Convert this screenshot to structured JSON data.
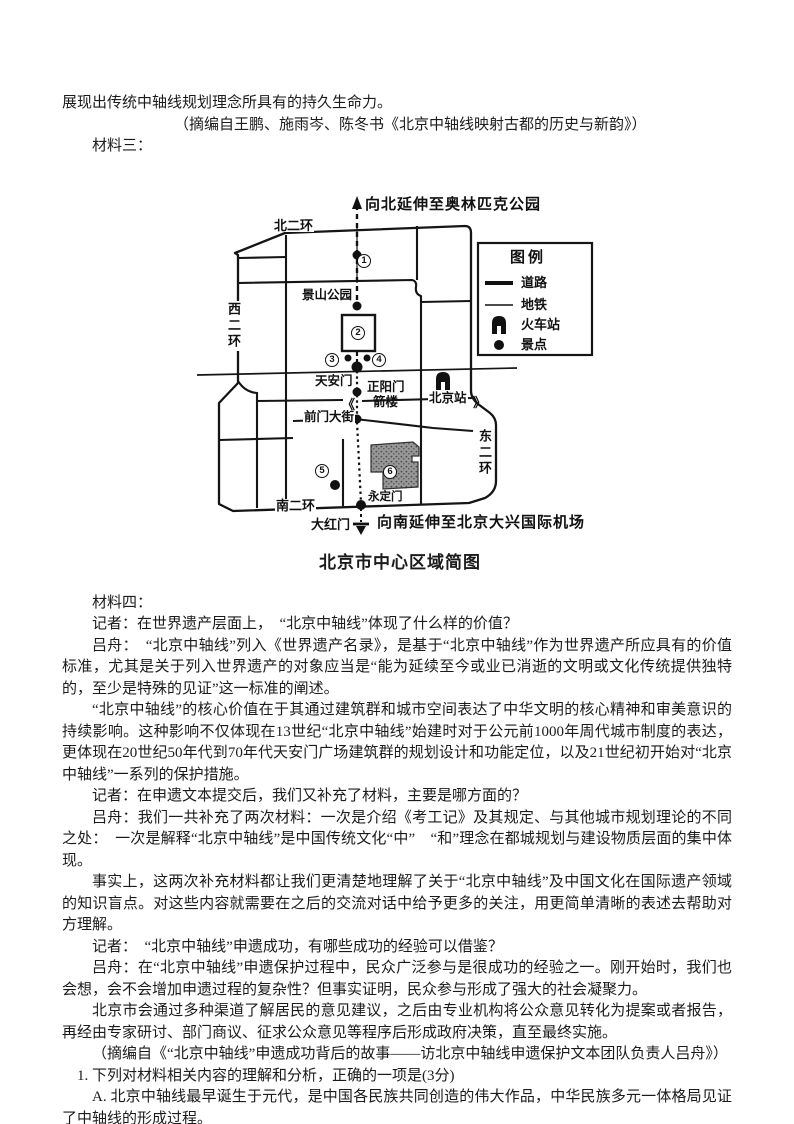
{
  "colors": {
    "ink": "#1b1b1b",
    "tiantan_gray": "#8f8f8f",
    "paper": "#ffffff"
  },
  "header": {
    "intro_line": "展现出传统中轴线规划理念所具有的持久生命力。",
    "source3": "（摘编自王鹏、施雨岑、陈冬书《北京中轴线映射古都的历史与新韵》）",
    "material3_label": "材料三："
  },
  "map": {
    "title": "北京市中心区域简图",
    "north_extension": "向北延伸至奥林匹克公园",
    "south_extension": "向南延伸至北京大兴国际机场",
    "ring_north": "北二环",
    "ring_west": "西二环",
    "ring_east": "东二环",
    "ring_south": "南二环",
    "jingshan": "景山公园",
    "tiananmen": "天安门",
    "zhengyangmen": "正阳门",
    "jianlou": "箭楼",
    "beijing_station": "北京站",
    "qianmen_street": "前门大街",
    "yongdingmen": "永定门",
    "dahongmen": "大红门",
    "break_left": "《",
    "break_right": "》",
    "spots": [
      "1",
      "2",
      "3",
      "4",
      "5",
      "6"
    ],
    "legend": {
      "title": "图例",
      "road": "道路",
      "subway": "地铁",
      "train_station": "火车站",
      "scenic_spot": "景点"
    }
  },
  "interview": {
    "material4_label": "材料四：",
    "paragraphs": [
      "记者：在世界遗产层面上，　“北京中轴线”体现了什么样的价值？",
      "吕舟：　“北京中轴线”列入《世界遗产名录》，是基于“北京中轴线”作为世界遗产所应具有的价值标准，尤其是关于列入世界遗产的对象应当是“能为延续至今或业已消逝的文明或文化传统提供独特的，至少是特殊的见证”这一标准的阐述。",
      "“北京中轴线”的核心价值在于其通过建筑群和城市空间表达了中华文明的核心精神和审美意识的持续影响。这种影响不仅体现在13世纪“北京中轴线”始建时对于公元前1000年周代城市制度的表达，更体现在20世纪50年代到70年代天安门广场建筑群的规划设计和功能定位，以及21世纪初开始对“北京中轴线”一系列的保护措施。",
      "记者：在申遗文本提交后，我们又补充了材料，主要是哪方面的？",
      "吕舟：我们一共补充了两次材料：一次是介绍《考工记》及其规定、与其他城市规划理论的不同之处：　一次是解释“北京中轴线”是中国传统文化“中”　“和”理念在都城规划与建设物质层面的集中体现。",
      "事实上，这两次补充材料都让我们更清楚地理解了关于“北京中轴线”及中国文化在国际遗产领域的知识盲点。对这些内容就需要在之后的交流对话中给予更多的关注，用更简单清晰的表述去帮助对方理解。",
      "记者：　“北京中轴线”申遗成功，有哪些成功的经验可以借鉴？",
      "吕舟：在“北京中轴线”申遗保护过程中，民众广泛参与是很成功的经验之一。刚开始时，我们也会想，会不会增加申遗过程的复杂性？但事实证明，民众参与形成了强大的社会凝聚力。",
      "北京市会通过多种渠道了解居民的意见建议，之后由专业机构将公众意见转化为提案或者报告，再经由专家研讨、部门商议、征求公众意见等程序后形成政府决策，直至最终实施。",
      "（摘编自《“北京中轴线”申遗成功背后的故事——访北京中轴线申遗保护文本团队负责人吕舟》）"
    ]
  },
  "question": {
    "stem": "1. 下列对材料相关内容的理解和分析，正确的一项是(3分)",
    "option_a": "A. 北京中轴线最早诞生于元代，是中国各民族共同创造的伟大作品，中华民族多元一体格局见证了中轴线的形成过程。",
    "option_b": "B. 北京中轴线参照天地宇宙秩序而建，在建筑的布局和命名以及区域选址上，都体现了中华文明“天"
  }
}
